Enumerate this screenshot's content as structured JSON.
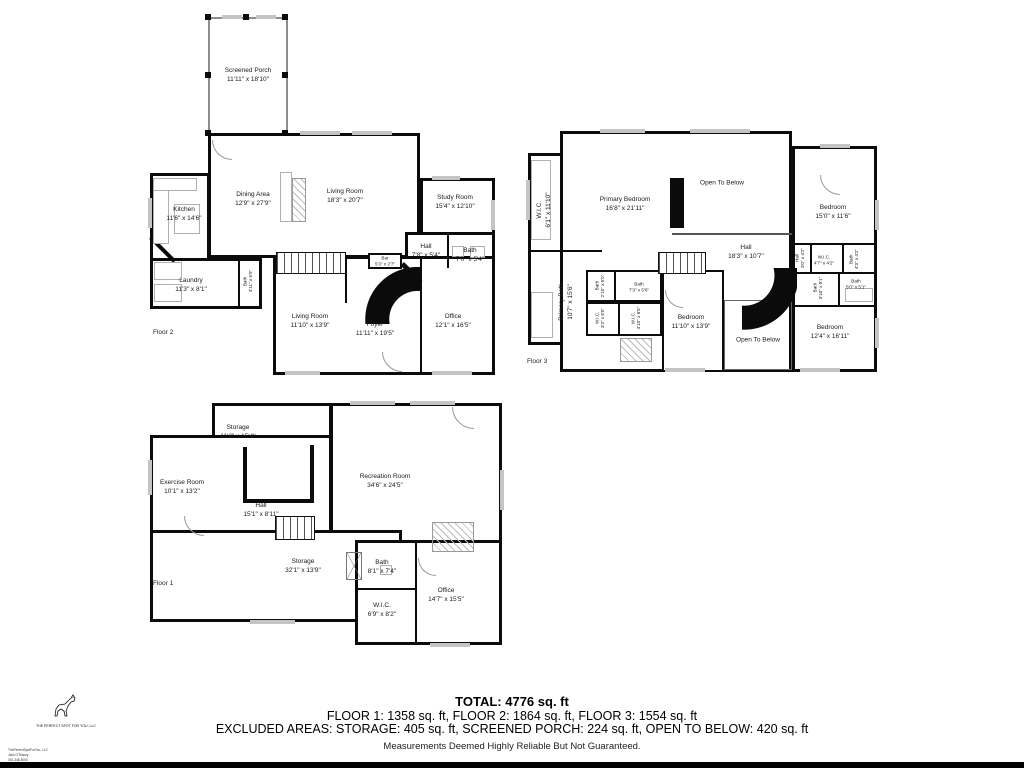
{
  "colors": {
    "background": "#ffffff",
    "wall": "#0b0b0b",
    "window": "#c4c4c4",
    "bottom_bar": "#000000"
  },
  "floors": [
    {
      "id": "floor-2",
      "label": "Floor 2",
      "rooms": [
        {
          "name": "Screened Porch",
          "dims": "11'11\" x 18'10\""
        },
        {
          "name": "Kitchen",
          "dims": "11'6\" x 14'6\""
        },
        {
          "name": "Dining Area",
          "dims": "12'9\" x 27'9\""
        },
        {
          "name": "Living Room",
          "dims": "18'3\" x 20'7\""
        },
        {
          "name": "Study Room",
          "dims": "15'4\" x 12'10\""
        },
        {
          "name": "Laundry",
          "dims": "11'3\" x 8'1\""
        },
        {
          "name": "Bath",
          "dims": "4'11\" x 5'5\""
        },
        {
          "name": "Bar",
          "dims": "5'3\" x 2'7\""
        },
        {
          "name": "Hall",
          "dims": "7'8\" x 5'4\""
        },
        {
          "name": "Bath",
          "dims": "7'0\" x 5'4\""
        },
        {
          "name": "Living Room",
          "dims": "11'10\" x 13'9\""
        },
        {
          "name": "Foyer",
          "dims": "11'11\" x 19'5\""
        },
        {
          "name": "Office",
          "dims": "12'1\" x 16'5\""
        }
      ]
    },
    {
      "id": "floor-3",
      "label": "Floor 3",
      "rooms": [
        {
          "name": "W.I.C.",
          "dims": "6'1\" x 11'10\""
        },
        {
          "name": "Primary Bedroom",
          "dims": "16'8\" x 21'11\""
        },
        {
          "name": "Open To Below",
          "dims": ""
        },
        {
          "name": "Bedroom",
          "dims": "15'0\" x 11'6\""
        },
        {
          "name": "Hall",
          "dims": "18'3\" x 10'7\""
        },
        {
          "name": "Primary Bath",
          "dims": "10'7\" x 15'6\""
        },
        {
          "name": "Bath",
          "dims": "2'10\" x 5'0\""
        },
        {
          "name": "Bath",
          "dims": "7'3\" x 5'6\""
        },
        {
          "name": "W.I.C.",
          "dims": "3'4\" x 6'5\""
        },
        {
          "name": "W.I.C.",
          "dims": "4'10\" x 6'5\""
        },
        {
          "name": "Bedroom",
          "dims": "11'10\" x 13'9\""
        },
        {
          "name": "Open To Below",
          "dims": ""
        },
        {
          "name": "Bedroom",
          "dims": "12'4\" x 16'11\""
        },
        {
          "name": "Hall",
          "dims": "3'0\" x 4'2\""
        },
        {
          "name": "W.I.C.",
          "dims": "4'7\" x 4'2\""
        },
        {
          "name": "Bath",
          "dims": "4'3\" x 4'2\""
        },
        {
          "name": "Bath",
          "dims": "3'10\" x 5'1\""
        },
        {
          "name": "Bath",
          "dims": "5'0\" x 5'1\""
        }
      ]
    },
    {
      "id": "floor-1",
      "label": "Floor 1",
      "rooms": [
        {
          "name": "Storage",
          "dims": "11'3\" x 15'4\""
        },
        {
          "name": "Exercise Room",
          "dims": "10'1\" x 13'2\""
        },
        {
          "name": "Recreation Room",
          "dims": "34'6\" x 24'5\""
        },
        {
          "name": "Hall",
          "dims": "15'1\" x 8'11\""
        },
        {
          "name": "Storage",
          "dims": "32'1\" x 13'9\""
        },
        {
          "name": "Bath",
          "dims": "8'1\" x 7'4\""
        },
        {
          "name": "W.I.C.",
          "dims": "6'9\" x 8'2\""
        },
        {
          "name": "Office",
          "dims": "14'7\" x 15'5\""
        }
      ]
    }
  ],
  "summary": {
    "total": "TOTAL: 4776 sq. ft",
    "floors_line": "FLOOR 1: 1358 sq. ft, FLOOR 2: 1864 sq. ft, FLOOR 3: 1554 sq. ft",
    "excluded_line": "EXCLUDED AREAS: STORAGE: 405 sq. ft, SCREENED PORCH: 224 sq. ft, OPEN TO BELOW: 420 sq. ft",
    "disclaimer": "Measurements Deemed Highly Reliable But Not Guaranteed."
  },
  "logo": {
    "company": "THE PERFECT SPOT FOR YOU, LLC",
    "fine_print_1": "ThePerfectSpotForYou, LLC",
    "fine_print_2": "Jack O'Teskey",
    "fine_print_3": "301-348-5000"
  }
}
